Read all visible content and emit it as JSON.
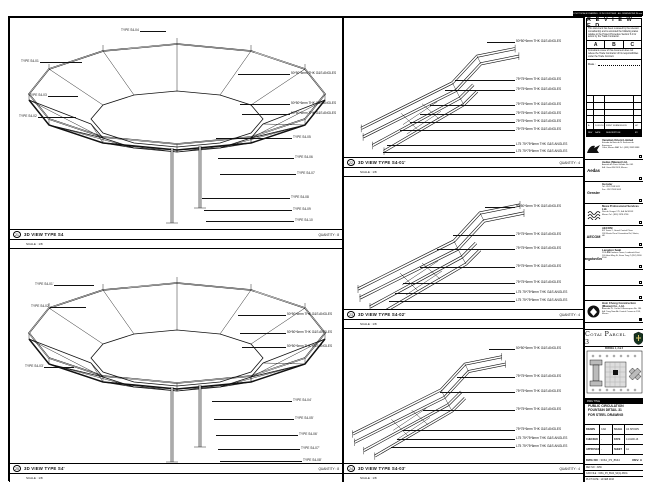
{
  "sheet": {
    "top_note": "DO NOT SCALE DRAWING . IF IN DOUBT ASK . ALL DIMENSIONS IN mm"
  },
  "panels": {
    "p1": {
      "num": "21",
      "title": "3D VIEW TYPE S4",
      "quantity": "QUANTITY : 8",
      "scale": "SCALE : 1/8",
      "labels": [
        {
          "x": 10,
          "y": 44,
          "side": "l",
          "len": 42,
          "text": "TYPE S4-01"
        },
        {
          "x": 8,
          "y": 99,
          "side": "l",
          "len": 38,
          "text": "TYPE S4-02"
        },
        {
          "x": 18,
          "y": 78,
          "side": "l",
          "len": 30,
          "text": "TYPE S4-03"
        },
        {
          "x": 110,
          "y": 13,
          "side": "l",
          "len": 26,
          "text": "TYPE S4-04"
        },
        {
          "x": 228,
          "y": 56,
          "len": 52,
          "text": "50*50*6mm THK G&S ANGLES"
        },
        {
          "x": 230,
          "y": 86,
          "len": 50,
          "text": "50*50*6mm THK G&S ANGLES"
        },
        {
          "x": 232,
          "y": 96,
          "len": 48,
          "text": "50*50*6mm THK G&S ANGLES"
        },
        {
          "x": 206,
          "y": 120,
          "len": 76,
          "text": "TYPE S4-05"
        },
        {
          "x": 208,
          "y": 140,
          "len": 76,
          "text": "TYPE S4-06"
        },
        {
          "x": 210,
          "y": 156,
          "len": 76,
          "text": "TYPE S4-07"
        },
        {
          "x": 192,
          "y": 180,
          "len": 88,
          "text": "TYPE S4-08"
        },
        {
          "x": 194,
          "y": 192,
          "len": 88,
          "text": "TYPE S4-09"
        },
        {
          "x": 196,
          "y": 203,
          "len": 88,
          "text": "TYPE S4-10"
        }
      ]
    },
    "p2": {
      "num": "25",
      "title": "3D VIEW TYPE S4'",
      "quantity": "QUANTITY : 8",
      "scale": "SCALE : 1/8",
      "labels": [
        {
          "x": 24,
          "y": 36,
          "side": "l",
          "len": 40,
          "text": "TYPE S4-01'"
        },
        {
          "x": 20,
          "y": 58,
          "side": "l",
          "len": 36,
          "text": "TYPE S4-02'"
        },
        {
          "x": 14,
          "y": 118,
          "side": "l",
          "len": 30,
          "text": "TYPE S4-03'"
        },
        {
          "x": 228,
          "y": 66,
          "len": 48,
          "text": "50*50*6mm THK G&S ANGLES"
        },
        {
          "x": 230,
          "y": 84,
          "len": 46,
          "text": "50*50*6mm THK G&S ANGLES"
        },
        {
          "x": 232,
          "y": 98,
          "len": 44,
          "text": "50*50*6mm THK G&S ANGLES"
        },
        {
          "x": 202,
          "y": 152,
          "len": 80,
          "text": "TYPE S4-04'"
        },
        {
          "x": 204,
          "y": 170,
          "len": 80,
          "text": "TYPE S4-05'"
        },
        {
          "x": 206,
          "y": 186,
          "len": 82,
          "text": "TYPE S4-06'"
        },
        {
          "x": 208,
          "y": 200,
          "len": 82,
          "text": "TYPE S4-07'"
        },
        {
          "x": 210,
          "y": 212,
          "len": 82,
          "text": "TYPE S4-08'"
        }
      ]
    },
    "m1": {
      "num": "22",
      "title": "3D VIEW TYPE S4-01'",
      "quantity": "QUANTITY : 4",
      "scale": "SCALE : 1/8",
      "labels": [
        {
          "x": 143,
          "y": 24,
          "len": 28,
          "text": "50*50*6mm THK G&S ANGLES"
        },
        {
          "x": 111,
          "y": 62,
          "len": 60,
          "text": "75*75*6mm THK G&S ANGLES"
        },
        {
          "x": 101,
          "y": 72,
          "len": 70,
          "text": "75*75*6mm THK G&S ANGLES"
        },
        {
          "x": 86,
          "y": 87,
          "len": 85,
          "text": "75*75*6mm THK G&S ANGLES"
        },
        {
          "x": 76,
          "y": 96,
          "len": 95,
          "text": "75*75*6mm THK G&S ANGLES"
        },
        {
          "x": 66,
          "y": 104,
          "len": 105,
          "text": "75*75*6mm THK G&S ANGLES"
        },
        {
          "x": 56,
          "y": 112,
          "len": 115,
          "text": "75*75*6mm THK G&S ANGLES"
        },
        {
          "x": 43,
          "y": 127,
          "len": 128,
          "text": "L75 75*75*6mm THK G&S ANGLES"
        },
        {
          "x": 39,
          "y": 134,
          "len": 132,
          "text": "L75 75*75*6mm THK G&S ANGLES"
        }
      ]
    },
    "m2": {
      "num": "23",
      "title": "3D VIEW TYPE S4-02'",
      "quantity": "QUANTITY : 4",
      "scale": "SCALE : 1/8",
      "labels": [
        {
          "x": 141,
          "y": 30,
          "len": 30,
          "text": "50*50*6mm THK G&S ANGLES"
        },
        {
          "x": 109,
          "y": 58,
          "len": 62,
          "text": "75*75*6mm THK G&S ANGLES"
        },
        {
          "x": 93,
          "y": 72,
          "len": 78,
          "text": "75*75*6mm THK G&S ANGLES"
        },
        {
          "x": 76,
          "y": 90,
          "len": 95,
          "text": "75*75*6mm THK G&S ANGLES"
        },
        {
          "x": 59,
          "y": 106,
          "len": 112,
          "text": "75*75*6mm THK G&S ANGLES"
        },
        {
          "x": 51,
          "y": 116,
          "len": 120,
          "text": "L75 75*75*6mm THK G&S ANGLES"
        },
        {
          "x": 45,
          "y": 124,
          "len": 126,
          "text": "L75 75*75*6mm THK G&S ANGLES"
        }
      ]
    },
    "m3": {
      "num": "24",
      "title": "3D VIEW TYPE S4-03'",
      "quantity": "QUANTITY : 4",
      "scale": "SCALE : 1/8",
      "labels": [
        {
          "x": 145,
          "y": 20,
          "len": 26,
          "text": "50*50*6mm THK G&S ANGLES"
        },
        {
          "x": 113,
          "y": 48,
          "len": 58,
          "text": "75*75*6mm THK G&S ANGLES"
        },
        {
          "x": 96,
          "y": 63,
          "len": 75,
          "text": "75*75*6mm THK G&S ANGLES"
        },
        {
          "x": 79,
          "y": 81,
          "len": 92,
          "text": "75*75*6mm THK G&S ANGLES"
        },
        {
          "x": 59,
          "y": 101,
          "len": 112,
          "text": "75*75*6mm THK G&S ANGLES"
        },
        {
          "x": 53,
          "y": 110,
          "len": 118,
          "text": "L75 75*75*6mm THK G&S ANGLES"
        },
        {
          "x": 47,
          "y": 118,
          "len": 124,
          "text": "L75 75*75*6mm THK G&S ANGLES"
        }
      ]
    }
  },
  "titleblock": {
    "reviewed": {
      "title": "R E V I E W E D",
      "para1": "This document has been reviewed by the relevant consultant(s) and is accorded the following status relative to the Project Procedure Section 5.4 for action by the Trade Contractor.",
      "statuses": [
        "A",
        "B",
        "C"
      ],
      "para2": "Consultant review of this document does not relieve the Trade Contractor of his responsibilities under the Trade Contract.",
      "date_label": "Date :"
    },
    "revisions": {
      "headers": [
        "REV",
        "DATE",
        "DESCRIPTION",
        "BY"
      ],
      "row": [
        "A",
        "14.03.16",
        "FIRST SUBMISSION",
        "HC"
      ]
    },
    "consultants": [
      {
        "name": "Venetian Orient Limited",
        "addr1": "Estrada da Baia de N. Senhora da Esperanca",
        "addr2": "Cotai, Macau SAR   Tel : (853) 2882 8888"
      },
      {
        "logo_text": "Aedas",
        "name": "Aedas (Macau) Ltd.",
        "addr1": "Avenida da Praia Grande No. 665",
        "addr2": "Edf. Great Will 14/F, Macau"
      },
      {
        "logo_text": "Gensler",
        "name": "Gensler",
        "addr1": "Tel : 852 2598 9011",
        "addr2": "Fax : 852 2598 9003"
      },
      {
        "name": "Meca Professional Services Ltd.",
        "addr1": "Rua de Xangai 175, Edf. ACM 8/F",
        "addr2": "Macau   Tel : (853) 2878 6786"
      },
      {
        "logo_text": "AECOM",
        "name": "AECOM",
        "addr1": "8/F Tower 2, Grand Central Plaza",
        "addr2": "138 Shatin Rural Committee Rd, Shatin, HK"
      },
      {
        "logo_text": "LangdonSeah",
        "name": "Langdon Seah",
        "addr1": "23/F AIA Kowloon Tower, Landmark East",
        "addr2": "100 How Ming St, Kwun Tong   T (852) 2830 3500"
      }
    ],
    "contractor": {
      "name": "Hsin Chong Construction (Macau) Co., Ltd.",
      "addr1": "Alameda Dr. Carlos D'Assumpcao No. 180",
      "addr2": "Edf. Tong Nam Ah Central Comercio 19/F, Macau"
    },
    "project_bar": "PROJECT TITLE",
    "project_name": "Cotai Parcel 3",
    "keyplan_label": "PARCEL 1, 2 & 3",
    "dwg": {
      "header": "DWG TITLE",
      "line1": "PUBLIC CIRCULATION",
      "line2": "FOUNTAIN DETAIL 31",
      "line3": "FOR STEEL DRAWING"
    },
    "info": {
      "rows": [
        [
          "DRAWN",
          "CAD",
          "SCALE",
          "AS SHOWN"
        ],
        [
          "CHECKED",
          "-",
          "DATE",
          "14-MAR-16"
        ],
        [
          "APPROVED",
          "-",
          "SHEET",
          "A1"
        ]
      ]
    },
    "dwgno": {
      "label": "DWG NO :",
      "value": "315A_P3_8644",
      "rev": "REV. A"
    },
    "footer_rows": [
      "REF NO : 3156",
      "CAD FILE : 315A_P3_8644_S4(A).DWG",
      "PLOT DATE : 14 FEB 2016"
    ]
  }
}
